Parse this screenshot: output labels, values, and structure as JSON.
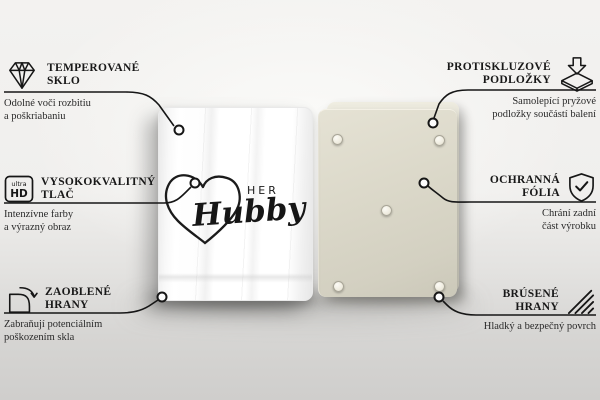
{
  "features": {
    "left": [
      {
        "icon": "diamond-icon",
        "title1": "TEMPEROVANÉ",
        "title2": "SKLO",
        "desc1": "Odolné voči rozbitiu",
        "desc2": "a poškriabaniu"
      },
      {
        "icon": "ultra-hd-icon",
        "title1": "VYSOKOKVALITNÝ",
        "title2": "TLAČ",
        "desc1": "Intenzívne farby",
        "desc2": "a výrazný obraz"
      },
      {
        "icon": "rounded-corner-icon",
        "title1": "ZAOBLENÉ",
        "title2": "HRANY",
        "desc1": "Zabraňují potenciálním",
        "desc2": "poškozením skla"
      }
    ],
    "right": [
      {
        "icon": "anti-slip-pad-icon",
        "title1": "PROTISKLUZOVÉ",
        "title2": "PODLOŽKY",
        "desc1": "Samolepící pryžové",
        "desc2": "podložky součástí balení"
      },
      {
        "icon": "shield-check-icon",
        "title1": "OCHRANNÁ",
        "title2": "FÓLIA",
        "desc1": "Chrání zadní",
        "desc2": "část výrobku"
      },
      {
        "icon": "hatched-edge-icon",
        "title1": "BRÚSENÉ",
        "title2": "HRANY",
        "desc1": "Hladký a bezpečný povrch",
        "desc2": ""
      }
    ]
  },
  "ultra_hd_badge": {
    "small": "ultra",
    "big": "HD"
  },
  "product": {
    "front_design": {
      "word_top": "HER",
      "word_script": "Hubby"
    }
  },
  "colors": {
    "line": "#161616",
    "front_board": "#ffffff",
    "back_board": "#d8d5c6",
    "background_top": "#f3f2f0",
    "background_bottom": "#cfcecc"
  }
}
